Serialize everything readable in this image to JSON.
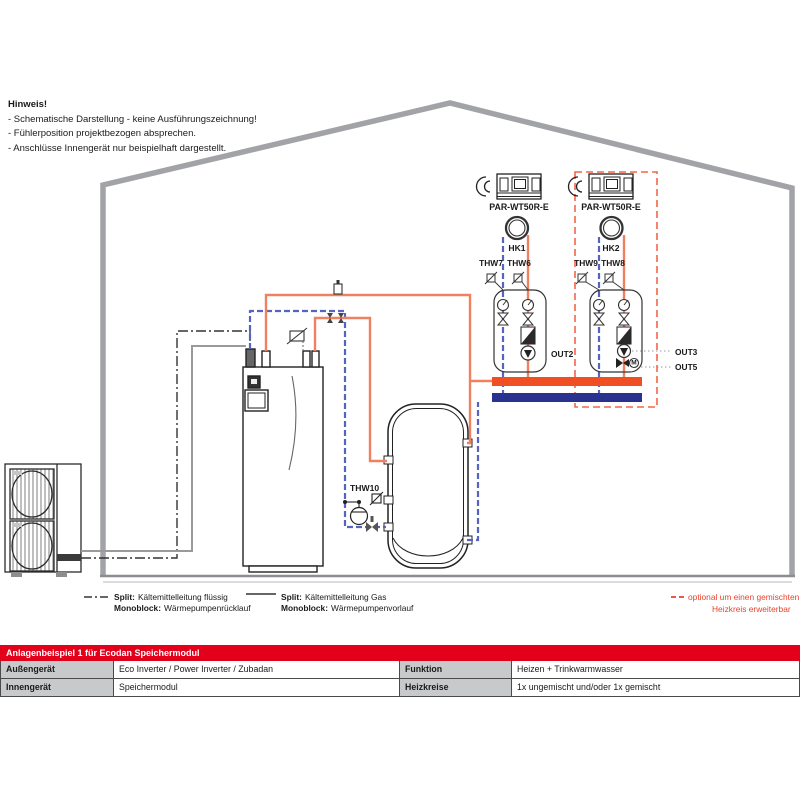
{
  "notes": {
    "title": "Hinweis!",
    "line1": "- Schematische Darstellung - keine Ausführungszeichnung!",
    "line2": "- Fühlerposition projektbezogen absprechen.",
    "line3": "- Anschlüsse Innengerät nur beispielhaft dargestellt."
  },
  "circuit1": {
    "controller": "PAR-WT50R-E",
    "pump": "HK1",
    "sensor_left": "THW7",
    "sensor_right": "THW6",
    "out": "OUT2"
  },
  "circuit2": {
    "controller": "PAR-WT50R-E",
    "pump": "HK2",
    "sensor_left": "THW9",
    "sensor_right": "THW8",
    "out_top": "OUT3",
    "out_bottom": "OUT5",
    "mixer_motor": "M"
  },
  "tank": {
    "sensor": "THW10"
  },
  "legend": {
    "item1": {
      "prefix1": "Split:",
      "text1": "Kältemittelleitung flüssig",
      "prefix2": "Monoblock:",
      "text2": "Wärmepumpenrücklauf"
    },
    "item2": {
      "prefix1": "Split:",
      "text1": "Kältemittelleitung Gas",
      "prefix2": "Monoblock:",
      "text2": "Wärmepumpenvorlauf"
    },
    "item3": {
      "line1": "optional um einen gemischten",
      "line2": "Heizkreis erweiterbar"
    }
  },
  "table": {
    "header": "Anlagenbeispiel 1 für Ecodan Speichermodul",
    "rows": [
      {
        "label1": "Außengerät",
        "value1": "Eco Inverter / Power Inverter / Zubadan",
        "label2": "Funktion",
        "value2": "Heizen + Trinkwarmwasser"
      },
      {
        "label1": "Innengerät",
        "value1": "Speichermodul",
        "label2": "Heizkreise",
        "value2": "1x ungemischt und/oder 1x gemischt"
      }
    ]
  },
  "colors": {
    "brand_red": "#e2001a",
    "pipe_orange": "#f08160",
    "manifold_flow_orange": "#f04e23",
    "manifold_return_blue": "#29338f",
    "pipe_return_blue": "#5663c2",
    "optional_dashed_red": "#f26649",
    "house_gray": "#a1a3a6",
    "table_label_gray": "#c8c9cb"
  }
}
